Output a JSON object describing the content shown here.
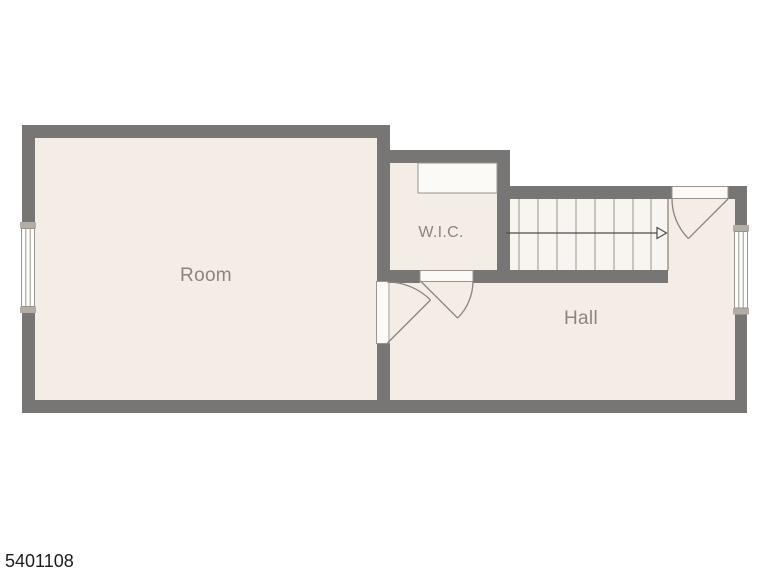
{
  "plan": {
    "id": "5401108",
    "rooms": [
      {
        "name": "room",
        "label": "Room"
      },
      {
        "name": "wic",
        "label": "W.I.C."
      },
      {
        "name": "hall",
        "label": "Hall"
      }
    ],
    "stairs": {
      "treads": 9,
      "arrow_direction": "right"
    },
    "windows": [
      {
        "name": "window-left"
      },
      {
        "name": "window-right"
      }
    ],
    "doors": [
      {
        "name": "room-door"
      },
      {
        "name": "wic-door"
      },
      {
        "name": "entry-door"
      }
    ],
    "colors": {
      "wall": "#777674",
      "floor": "#f4ede5",
      "stairs_floor": "#f8f5f0",
      "outline": "#9a948d",
      "swing": "#8b847e",
      "window_cap": "#b3ada6",
      "label_text": "#8b857e",
      "id_text": "#1c1c1c",
      "background": "#ffffff"
    }
  }
}
